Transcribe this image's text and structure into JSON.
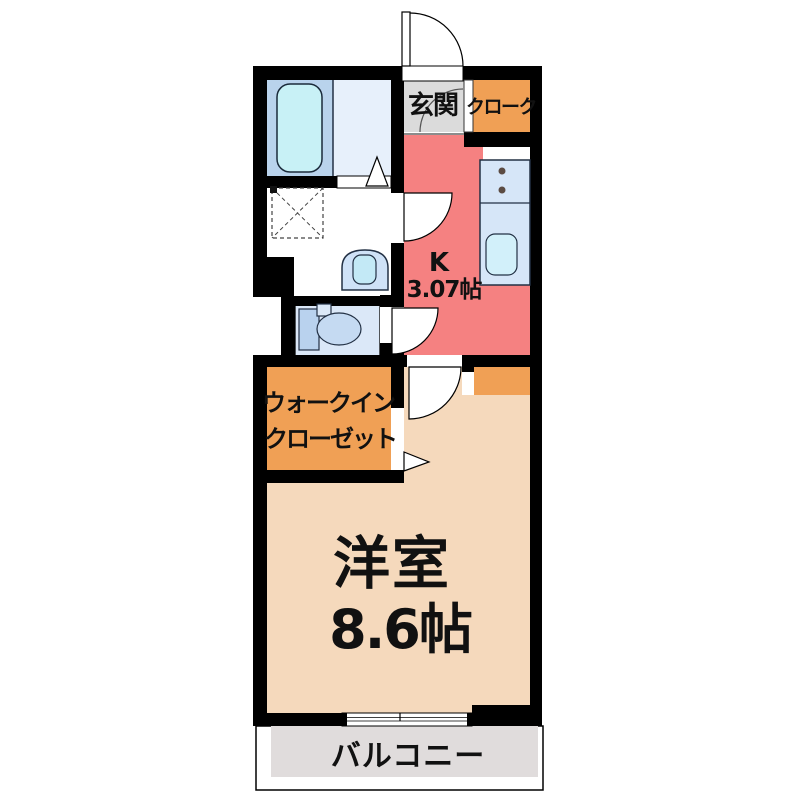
{
  "plan": {
    "rooms": {
      "entrance": {
        "label": "玄関"
      },
      "cloak": {
        "label": "クローク"
      },
      "kitchen": {
        "type": "K",
        "size": "3.07帖"
      },
      "walk_in_closet": {
        "line1": "ウォークイン",
        "line2": "クローゼット"
      },
      "western_room": {
        "name": "洋室",
        "size": "8.6帖"
      },
      "balcony": {
        "label": "バルコニー"
      }
    },
    "colors": {
      "wall": "#000000",
      "kitchen": "#f58181",
      "room": "#f5d9bc",
      "closet": "#f0a055",
      "entrance_floor": "#dbdbdb",
      "balcony": "#e0dcdc",
      "bath_left": "#b9d3ec",
      "bath_right": "#e7f0fb",
      "bathtub": "#c8f1f6",
      "toilet_floor": "#dbe8f8",
      "toilet_fixture": "#c5daf2",
      "counter": "#d6e6f8",
      "sink": "#d2f0fa"
    }
  }
}
